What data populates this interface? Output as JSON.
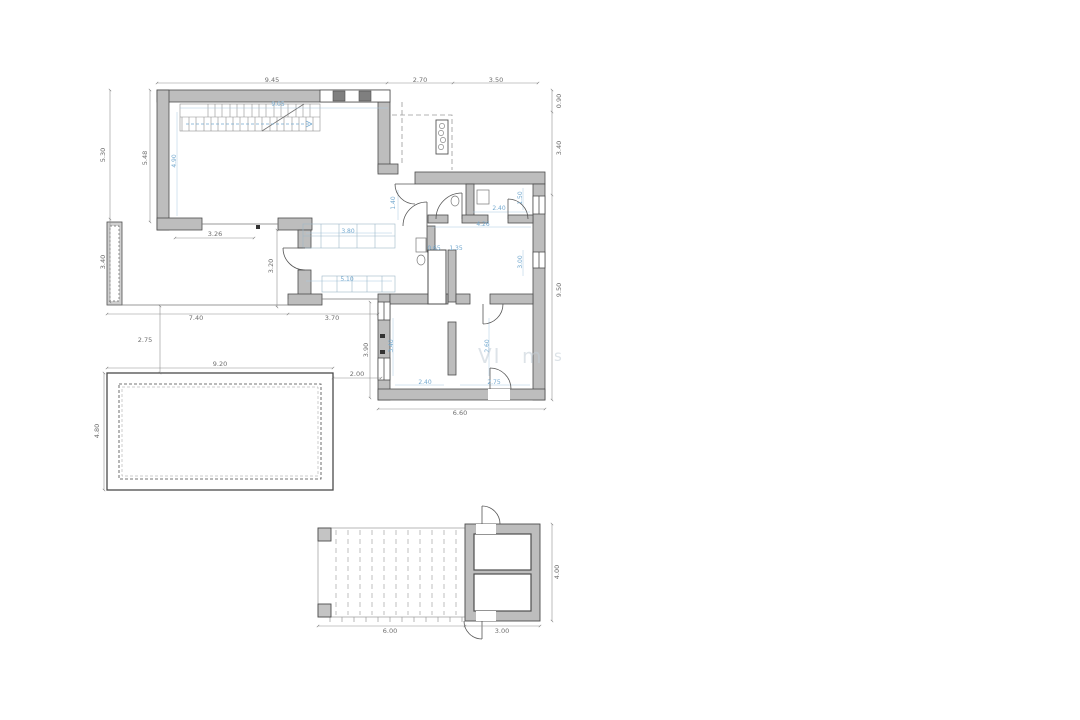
{
  "drawing": {
    "type": "architectural floor plan",
    "colors": {
      "wall_fill": "#bdbdbd",
      "wall_stroke": "#4d4d4d",
      "dim_line": "#8f8f8f",
      "dim_text": "#6e6e6e",
      "blue_dim": "#74a9cf",
      "background": "#ffffff"
    }
  },
  "watermark": {
    "part1": "VI",
    "part2": "m",
    "part3": "s"
  },
  "dimensions": {
    "gray": [
      {
        "t": "9.45",
        "x": 272,
        "y": 80,
        "r": 0
      },
      {
        "t": "2.70",
        "x": 420,
        "y": 80,
        "r": 0
      },
      {
        "t": "3.50",
        "x": 496,
        "y": 80,
        "r": 0
      },
      {
        "t": "0.90",
        "x": 559,
        "y": 101,
        "r": 1
      },
      {
        "t": "3.40",
        "x": 559,
        "y": 148,
        "r": 1
      },
      {
        "t": "9.50",
        "x": 559,
        "y": 290,
        "r": 1
      },
      {
        "t": "5.30",
        "x": 103,
        "y": 155,
        "r": 1
      },
      {
        "t": "3.40",
        "x": 103,
        "y": 262,
        "r": 1
      },
      {
        "t": "5.48",
        "x": 145,
        "y": 158,
        "r": 1
      },
      {
        "t": "2.75",
        "x": 145,
        "y": 340,
        "r": 0
      },
      {
        "t": "4.80",
        "x": 97,
        "y": 431,
        "r": 1
      },
      {
        "t": "9.20",
        "x": 220,
        "y": 364,
        "r": 0
      },
      {
        "t": "2.00",
        "x": 357,
        "y": 374,
        "r": 0
      },
      {
        "t": "3.90",
        "x": 366,
        "y": 350,
        "r": 1
      },
      {
        "t": "6.60",
        "x": 460,
        "y": 413,
        "r": 0
      },
      {
        "t": "3.26",
        "x": 215,
        "y": 234,
        "r": 0
      },
      {
        "t": "3.20",
        "x": 271,
        "y": 266,
        "r": 1
      },
      {
        "t": "7.40",
        "x": 196,
        "y": 318,
        "r": 0
      },
      {
        "t": "3.70",
        "x": 332,
        "y": 318,
        "r": 0
      },
      {
        "t": "6.00",
        "x": 390,
        "y": 631,
        "r": 0
      },
      {
        "t": "3.00",
        "x": 502,
        "y": 631,
        "r": 0
      },
      {
        "t": "4.00",
        "x": 557,
        "y": 572,
        "r": 1
      }
    ],
    "blue": [
      {
        "t": "9.05",
        "x": 278,
        "y": 105,
        "r": 0
      },
      {
        "t": "4.90",
        "x": 175,
        "y": 161,
        "r": 1
      },
      {
        "t": "3.80",
        "x": 348,
        "y": 232,
        "r": 0
      },
      {
        "t": "5.10",
        "x": 347,
        "y": 280,
        "r": 0
      },
      {
        "t": "1.40",
        "x": 394,
        "y": 203,
        "r": 1
      },
      {
        "t": "2.40",
        "x": 499,
        "y": 209,
        "r": 0
      },
      {
        "t": "4.26",
        "x": 483,
        "y": 225,
        "r": 0
      },
      {
        "t": "1.50",
        "x": 521,
        "y": 198,
        "r": 1
      },
      {
        "t": "3.00",
        "x": 521,
        "y": 262,
        "r": 1
      },
      {
        "t": "0.65",
        "x": 434,
        "y": 249,
        "r": 0
      },
      {
        "t": "1.35",
        "x": 456,
        "y": 249,
        "r": 0
      },
      {
        "t": "3.40",
        "x": 392,
        "y": 346,
        "r": 1
      },
      {
        "t": "2.60",
        "x": 488,
        "y": 346,
        "r": 1
      },
      {
        "t": "2.40",
        "x": 425,
        "y": 383,
        "r": 0
      },
      {
        "t": "2.75",
        "x": 494,
        "y": 383,
        "r": 0
      }
    ]
  }
}
